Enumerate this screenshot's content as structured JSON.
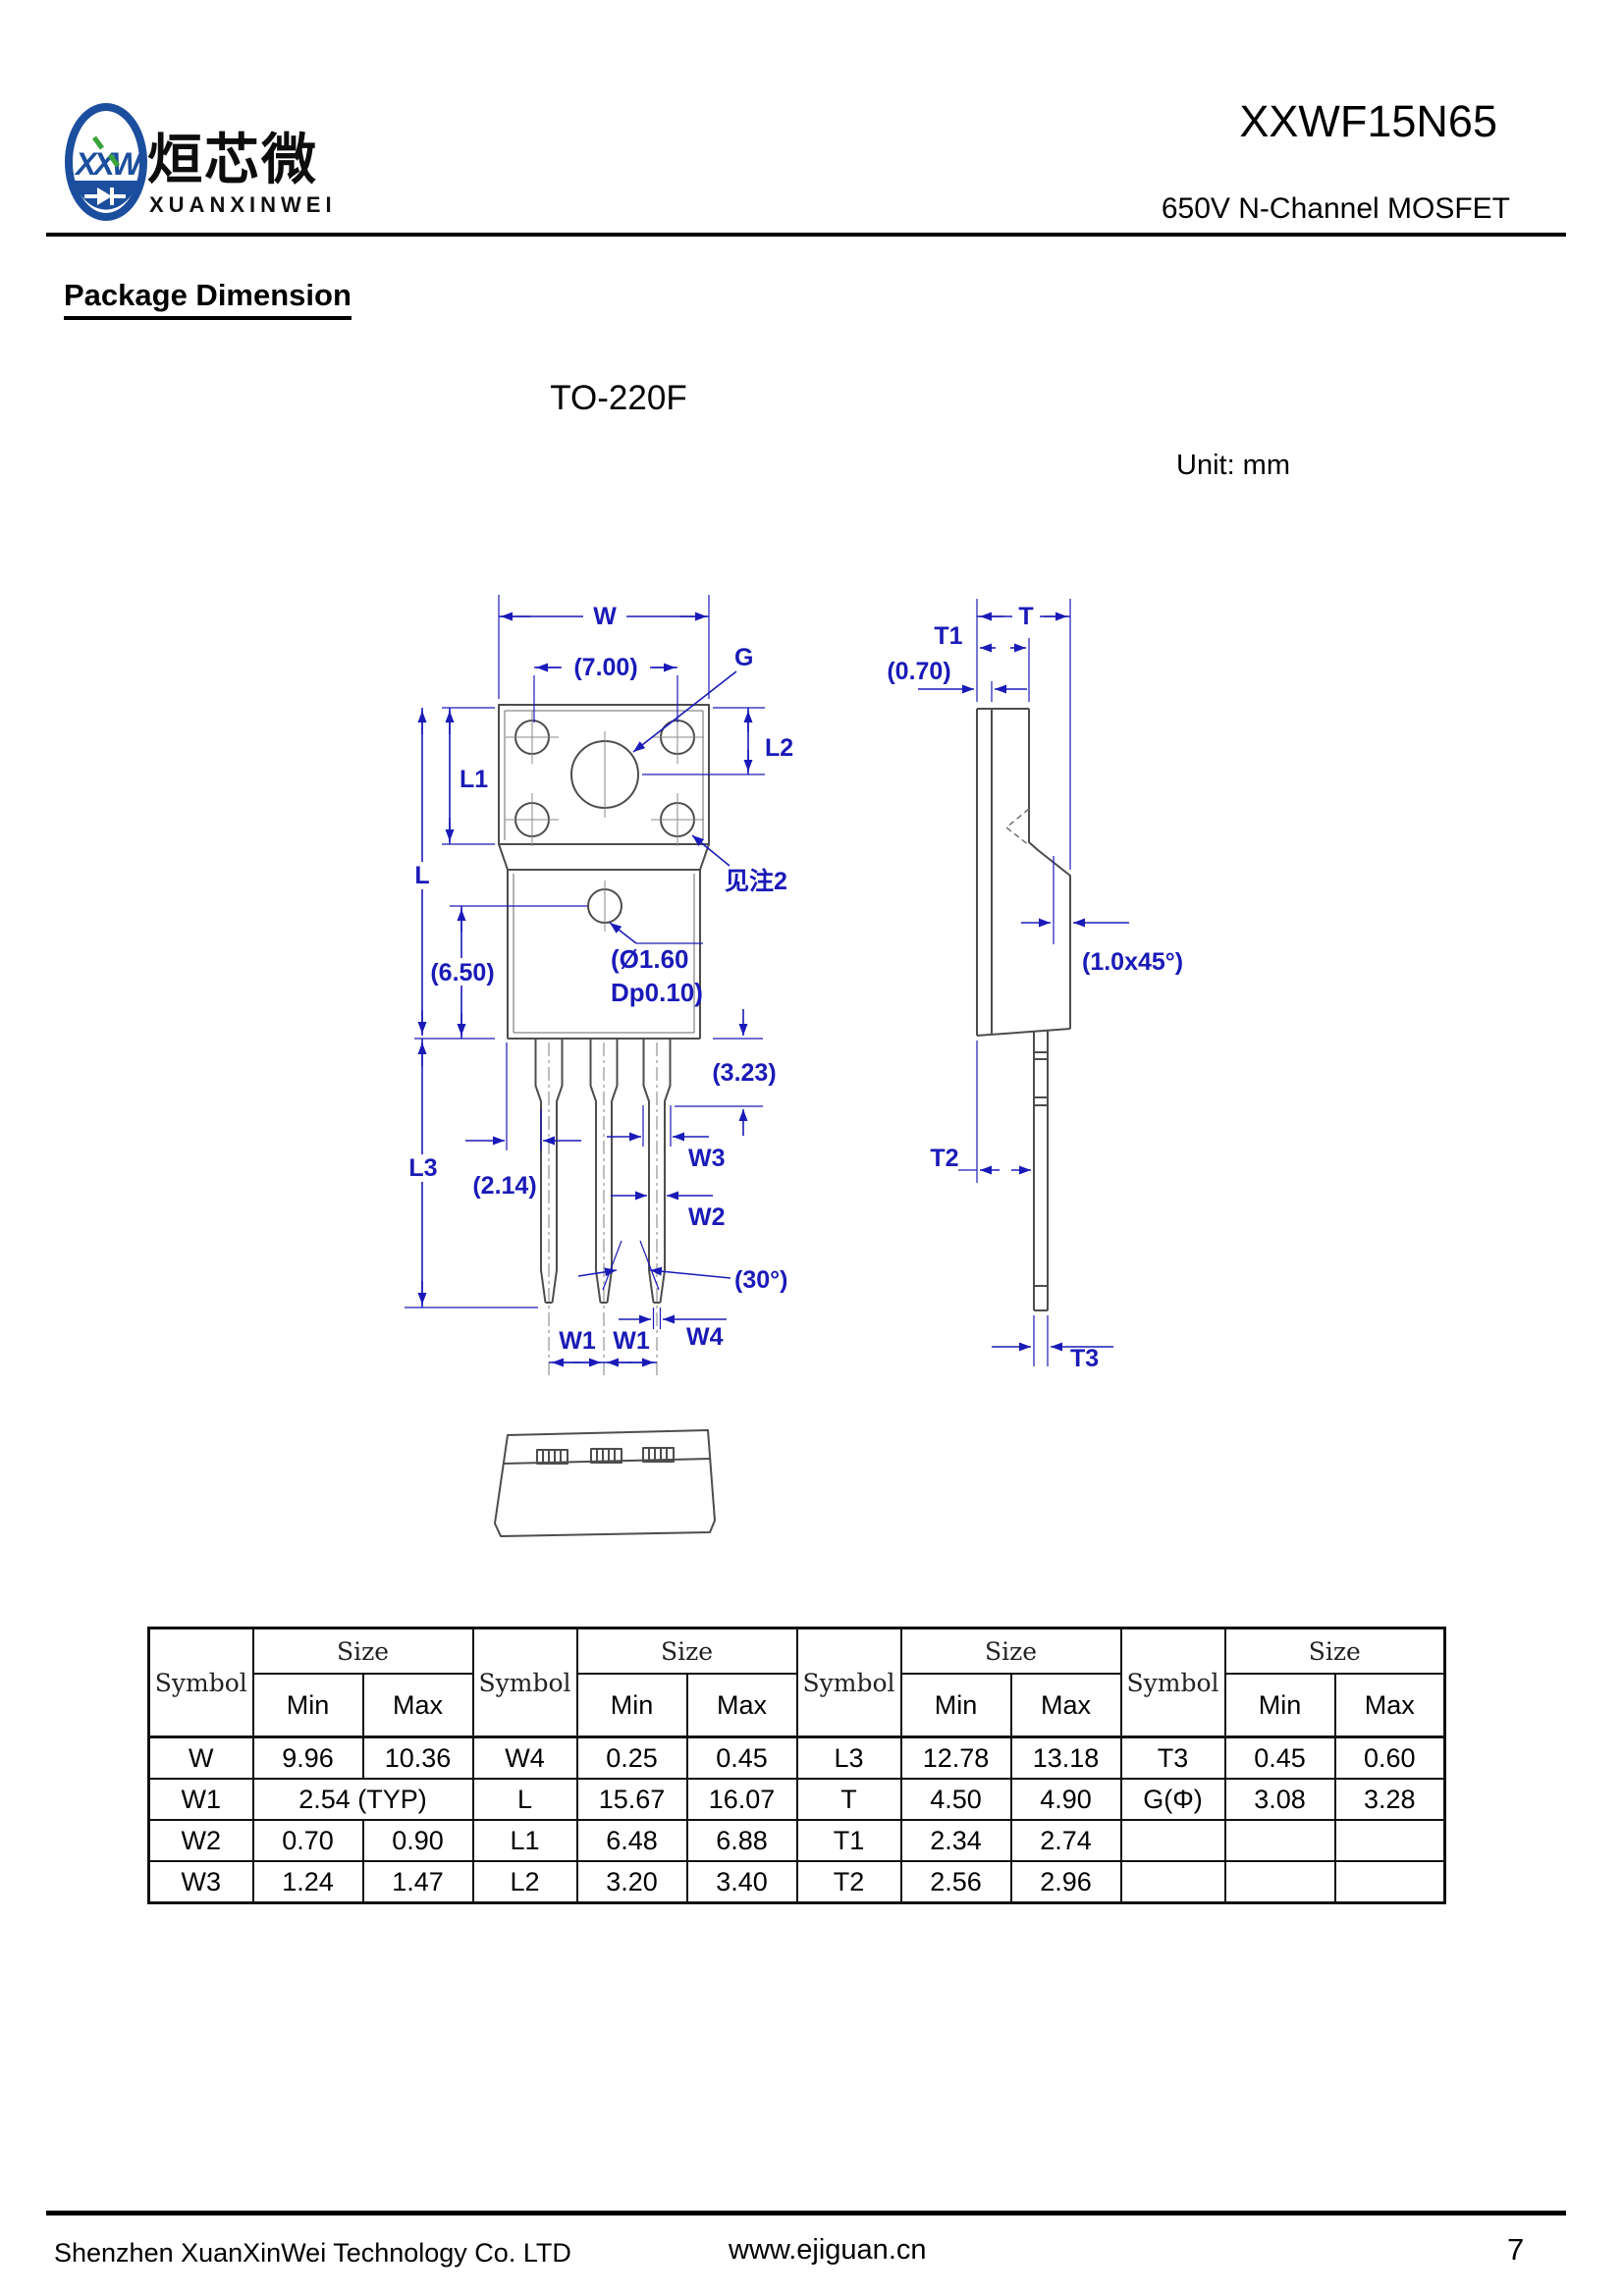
{
  "header": {
    "logo": {
      "monogram": "XXW",
      "cn_name": "烜芯微",
      "en_name": "XUANXINWEI"
    },
    "part_number": "XXWF15N65",
    "subtitle": "650V N-Channel MOSFET"
  },
  "page": {
    "section_title": "Package Dimension",
    "package_name": "TO-220F",
    "unit_note": "Unit: mm"
  },
  "drawing": {
    "labels": {
      "w": "W",
      "d700": "(7.00)",
      "g": "G",
      "l1": "L1",
      "l2": "L2",
      "l": "L",
      "note2": "见注2",
      "hole_line1": "(Ø1.60",
      "hole_line2": "Dp0.10)",
      "d650": "(6.50)",
      "d323": "(3.23)",
      "w3": "W3",
      "w2": "W2",
      "deg30": "(30°)",
      "w4": "W4",
      "w1": "W1",
      "l3": "L3",
      "d214": "(2.14)",
      "t": "T",
      "t1": "T1",
      "d070": "(0.70)",
      "chamfer": "(1.0x45°)",
      "t2": "T2",
      "t3": "T3"
    }
  },
  "dim_table": {
    "symbol_label": "Symbol",
    "size_label": "Size",
    "min_label": "Min",
    "max_label": "Max",
    "rows": [
      [
        "W",
        "9.96",
        "10.36",
        "W4",
        "0.25",
        "0.45",
        "L3",
        "12.78",
        "13.18",
        "T3",
        "0.45",
        "0.60"
      ],
      [
        "W1",
        "2.54 (TYP)",
        "L",
        "15.67",
        "16.07",
        "T",
        "4.50",
        "4.90",
        "G(Φ)",
        "3.08",
        "3.28"
      ],
      [
        "W2",
        "0.70",
        "0.90",
        "L1",
        "6.48",
        "6.88",
        "T1",
        "2.34",
        "2.74",
        "",
        "",
        ""
      ],
      [
        "W3",
        "1.24",
        "1.47",
        "L2",
        "3.20",
        "3.40",
        "T2",
        "2.56",
        "2.96",
        "",
        "",
        ""
      ]
    ]
  },
  "footer": {
    "company": "Shenzhen XuanXinWei Technology Co. LTD",
    "website": "www.ejiguan.cn",
    "page_number": "7"
  }
}
